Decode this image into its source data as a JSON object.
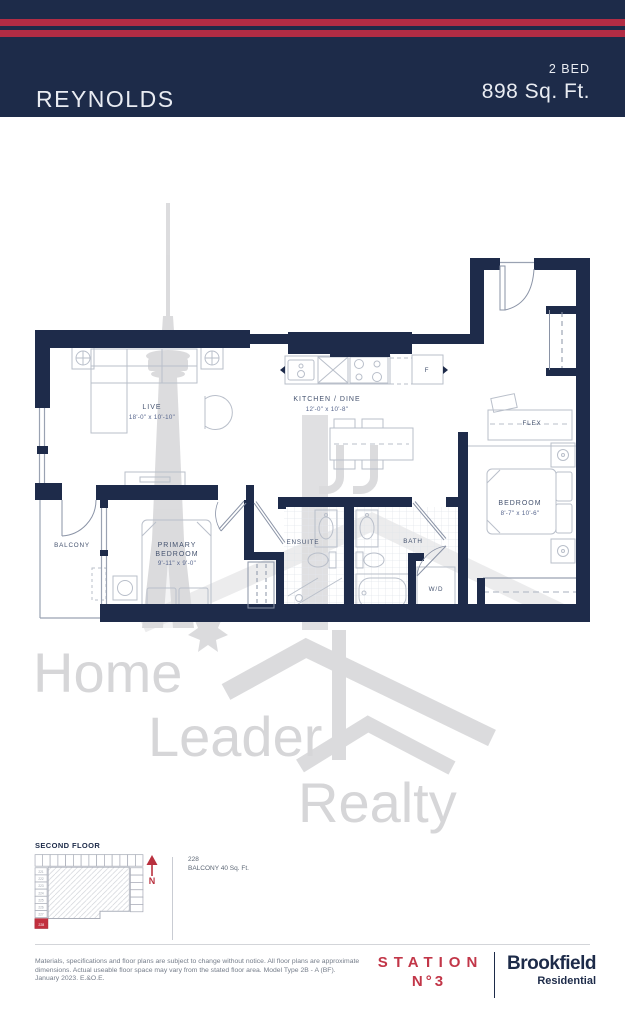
{
  "header": {
    "unit_name": "REYNOLDS",
    "bed_label": "2 BED",
    "sqft_label": "898 Sq. Ft."
  },
  "floorplan": {
    "rooms": {
      "live": {
        "name": "LIVE",
        "dims": "18'-0\" x 10'-10\""
      },
      "kitchen": {
        "name": "KITCHEN / DINE",
        "dims": "12'-0\" x 10'-8\""
      },
      "flex": {
        "name": "FLEX"
      },
      "bedroom": {
        "name": "BEDROOM",
        "dims": "8'-7\" x 10'-6\""
      },
      "primary": {
        "name_line1": "PRIMARY",
        "name_line2": "BEDROOM",
        "dims": "9'-11\" x 9'-0\""
      },
      "ensuite": {
        "name": "ENSUITE"
      },
      "bath": {
        "name": "BATH"
      },
      "laundry": {
        "name": "W/D"
      },
      "balcony": {
        "name": "BALCONY"
      },
      "fridge": {
        "name": "F"
      }
    }
  },
  "watermark": {
    "word1": "Home",
    "word2": "Leader",
    "word3": "Realty"
  },
  "keyplan": {
    "title": "SECOND FLOOR",
    "north_label": "N",
    "left_units": [
      "221",
      "222",
      "223",
      "224",
      "225",
      "226",
      "227"
    ],
    "highlight_unit": "228",
    "note_suite": "228",
    "note_balcony": "BALCONY 40 Sq. Ft."
  },
  "footer": {
    "disclaimer_line1": "Materials, specifications and floor plans are subject to change without notice. All floor plans are approximate",
    "disclaimer_line2": "dimensions. Actual useable floor space may vary from the stated floor area. Model Type 2B - A (BF).",
    "disclaimer_line3": "January 2023. E.&O.E.",
    "station_line1": "STATION",
    "station_line2": "N°3",
    "brookfield_line1": "Brookfield",
    "brookfield_line2": "Residential"
  },
  "colors": {
    "navy": "#1d2b49",
    "stripe_red": "#b22c44",
    "logo_red": "#c23648",
    "keyplan_red": "#c22f3e",
    "watermark_gray": "#d6d6d8"
  }
}
